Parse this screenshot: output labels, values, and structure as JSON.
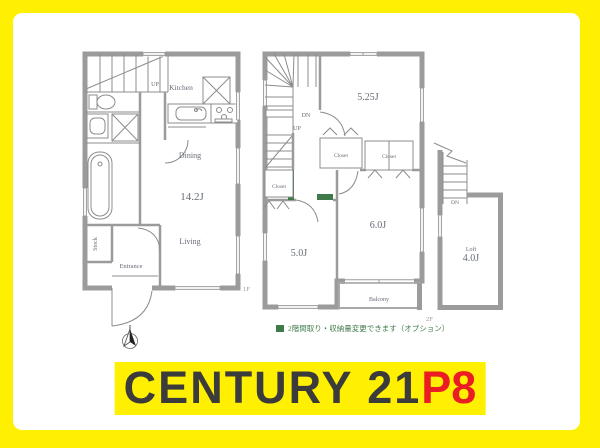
{
  "colors": {
    "frame_yellow": "#ffef00",
    "wall_gray": "#9b9b9b",
    "label_gray": "#666c76",
    "accent_green": "#3f7b4a",
    "logo_dark": "#3b3b3b",
    "logo_red": "#ea1c24"
  },
  "plan_1f": {
    "floor_label": "1F",
    "up_label": "UP",
    "kitchen": "Kitchen",
    "dining": "Dining",
    "living": "Living",
    "entrance": "Entrance",
    "stock": "Stock",
    "area": "14.2J"
  },
  "plan_2f": {
    "floor_label": "2F",
    "dn_label": "DN",
    "up_label": "UP",
    "closet_a": "Closet",
    "closet_b": "Closet",
    "closet_c": "Closet",
    "room_a_area": "5.25J",
    "room_b_area": "6.0J",
    "room_c_area": "5.0J",
    "balcony": "Balcony"
  },
  "plan_loft": {
    "dn_label": "DN",
    "name": "Loft",
    "area": "4.0J"
  },
  "note": {
    "text": "2階間取り・収納量変更できます（オプション）"
  },
  "logo": {
    "brand": "CENTURY 21",
    "suffix": "P8"
  }
}
